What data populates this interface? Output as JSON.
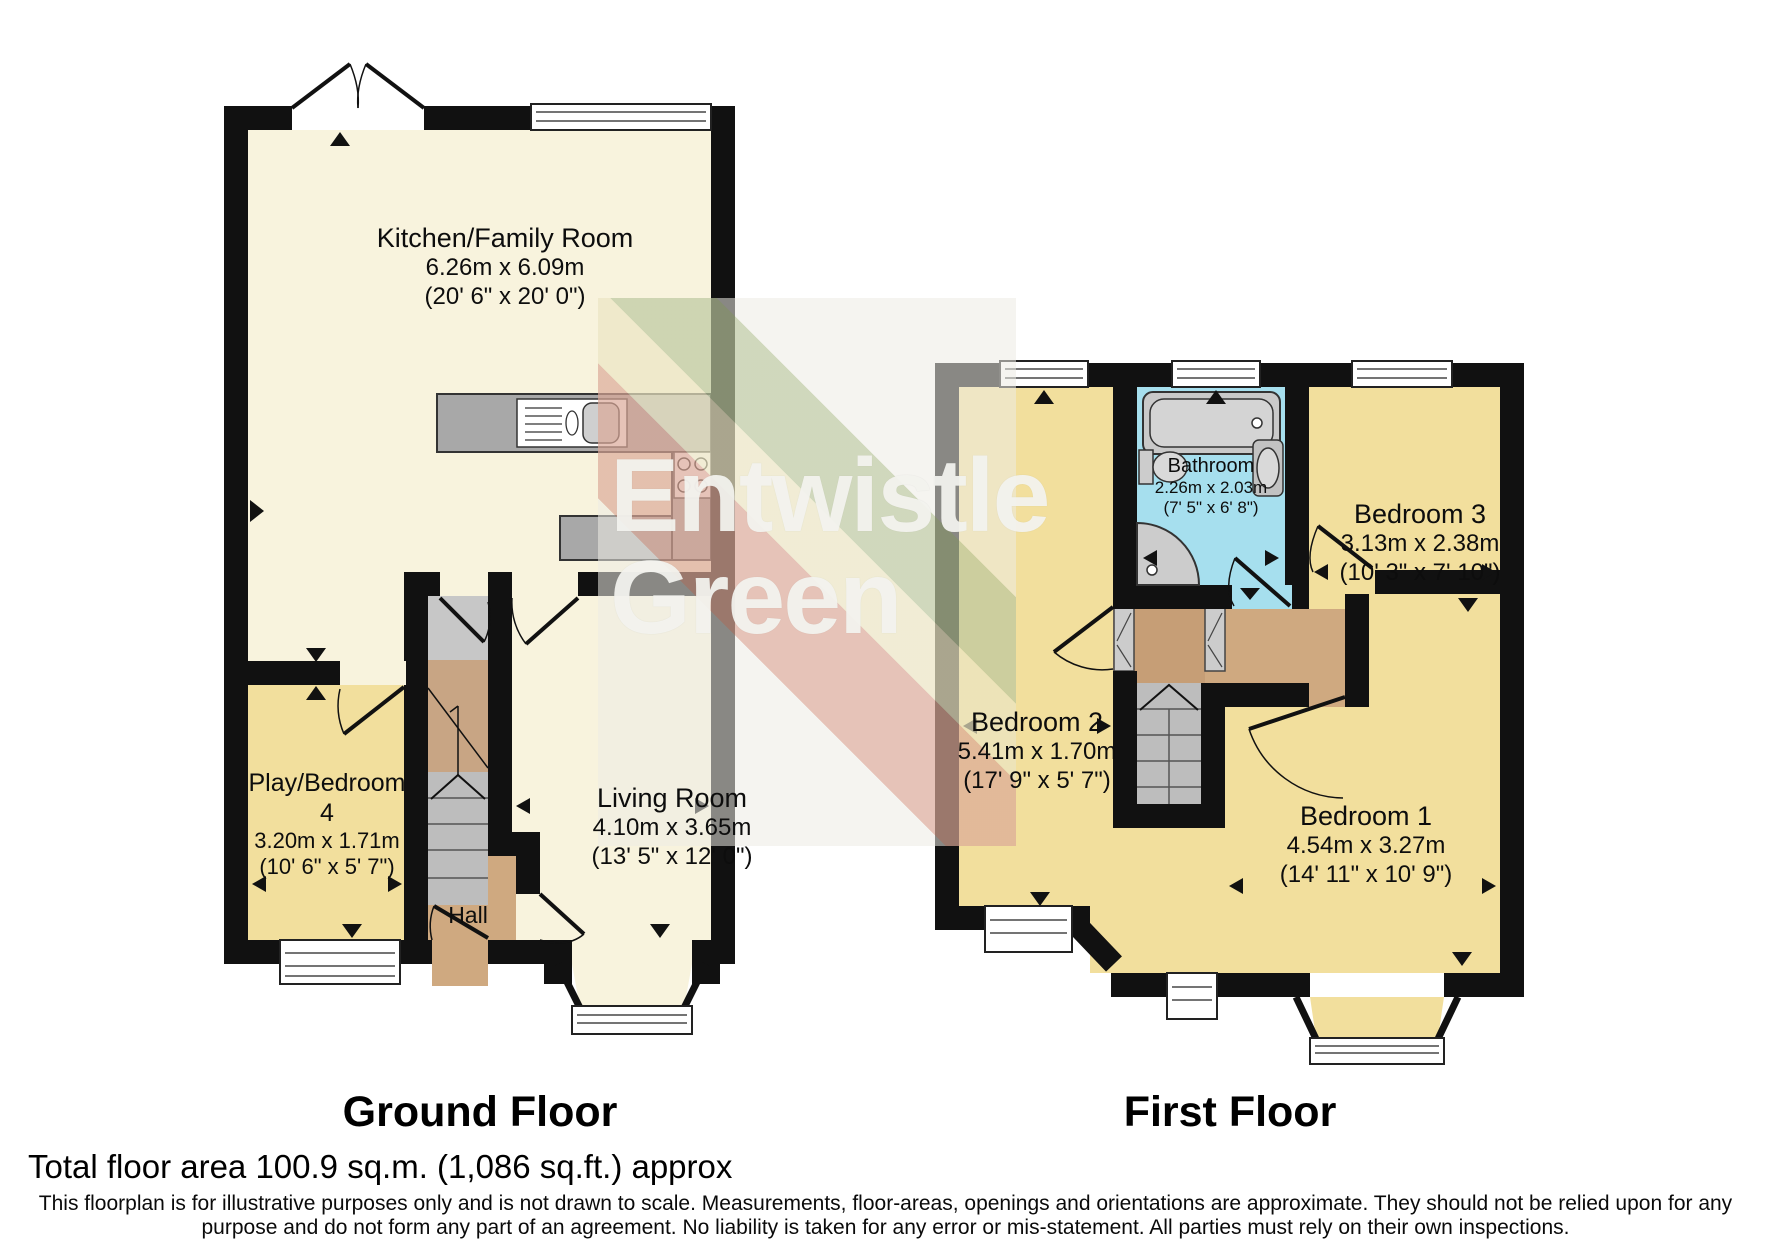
{
  "watermark": {
    "line1": "Entwistle",
    "line2": "Green"
  },
  "ground_floor": {
    "label": "Ground Floor",
    "rooms": {
      "kitchen": {
        "name": "Kitchen/Family Room",
        "metric": "6.26m x 6.09m",
        "imperial": "(20' 6\" x 20' 0\")"
      },
      "play_bedroom": {
        "name": "Play/Bedroom",
        "number": "4",
        "metric": "3.20m x 1.71m",
        "imperial": "(10' 6\" x 5' 7\")"
      },
      "living_room": {
        "name": "Living Room",
        "metric": "4.10m x 3.65m",
        "imperial": "(13' 5\" x 12' 0\")"
      },
      "hall": {
        "name": "Hall"
      }
    }
  },
  "first_floor": {
    "label": "First Floor",
    "rooms": {
      "bathroom": {
        "name": "Bathroom",
        "metric": "2.26m x 2.03m",
        "imperial": "(7' 5\" x 6' 8\")"
      },
      "bedroom1": {
        "name": "Bedroom 1",
        "metric": "4.54m x 3.27m",
        "imperial": "(14' 11\" x 10' 9\")"
      },
      "bedroom2": {
        "name": "Bedroom 2",
        "metric": "5.41m x 1.70m",
        "imperial": "(17' 9\" x 5' 7\")"
      },
      "bedroom3": {
        "name": "Bedroom 3",
        "metric": "3.13m x 2.38m",
        "imperial": "(10' 3\" x 7' 10\")"
      }
    }
  },
  "footer": {
    "total_area": "Total floor area 100.9 sq.m. (1,086 sq.ft.) approx",
    "disclaimer_line1": "This floorplan is for illustrative purposes only and is not drawn to scale. Measurements, floor-areas, openings and orientations are approximate. They should not be relied upon for any",
    "disclaimer_line2": "purpose and do not form any part of an agreement. No liability is taken for any error or mis-statement. All parties must rely on their own inspections."
  },
  "colors": {
    "wall": "#111111",
    "room_cream": "#f8f3dd",
    "room_yellow": "#f2df9d",
    "hall_tan": "#cfa980",
    "stair_brown": "#c8a584",
    "stair_grey": "#bdbdbd",
    "bathroom_blue": "#a6dfee",
    "counter_grey": "#a8a8a8"
  }
}
